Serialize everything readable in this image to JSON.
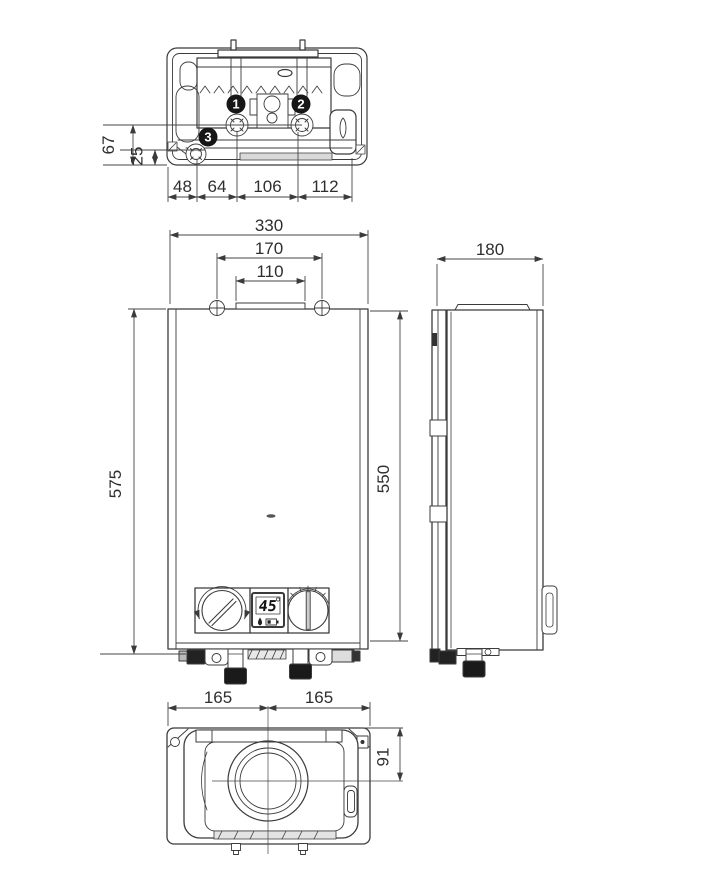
{
  "top_view": {
    "callouts": [
      {
        "label": "1"
      },
      {
        "label": "2"
      },
      {
        "label": "3"
      }
    ],
    "bottom_dims": [
      "48",
      "64",
      "106",
      "112"
    ],
    "left_dims": [
      "67",
      "25"
    ]
  },
  "front_view": {
    "top_dims": [
      "330",
      "170",
      "110"
    ],
    "left_dim": "575",
    "right_dim": "550",
    "display": {
      "temperature": "45"
    }
  },
  "side_view": {
    "top_dim": "180"
  },
  "bottom_view": {
    "top_dims": [
      "165",
      "165"
    ],
    "right_dim": "91"
  }
}
